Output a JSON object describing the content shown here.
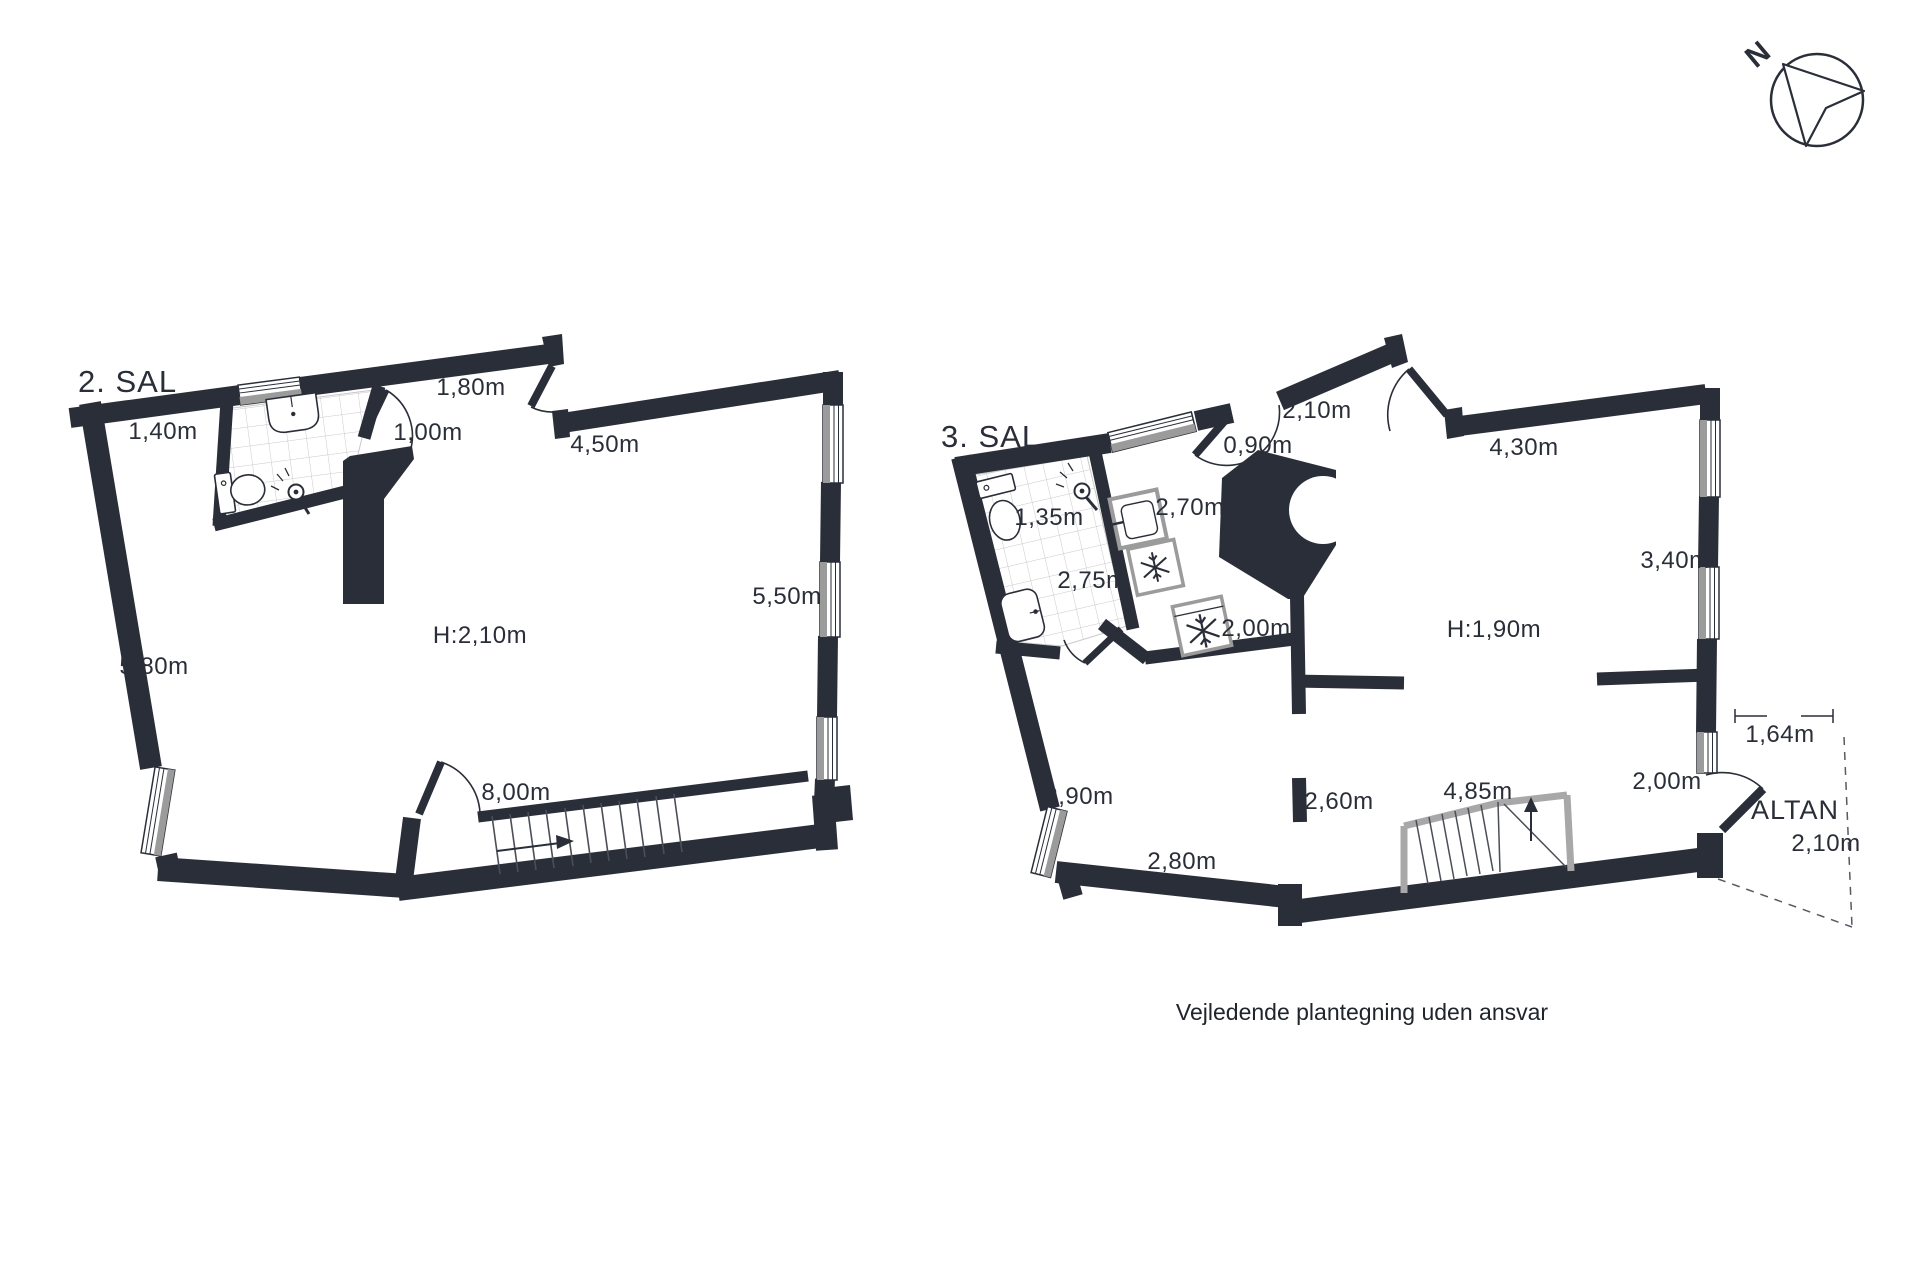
{
  "meta": {
    "footer": "Vejledende plantegning uden ansvar"
  },
  "compass": {
    "north_label": "N"
  },
  "colors": {
    "wall": "#2a2e38",
    "window_gray": "#9b9b9b",
    "tile_line": "#c9c9c9",
    "stair_gray": "#a8a8a8",
    "tread_line": "#4a4e57"
  },
  "plans": [
    {
      "title": "2. SAL",
      "labels": [
        {
          "text": "1,40m"
        },
        {
          "text": "1,80m"
        },
        {
          "text": "1,00m"
        },
        {
          "text": "4,50m"
        },
        {
          "text": "5,50m"
        },
        {
          "text": "5,80m"
        },
        {
          "text": "H:2,10m"
        },
        {
          "text": "8,00m"
        }
      ]
    },
    {
      "title": "3. SAL",
      "labels": [
        {
          "text": "2,10m"
        },
        {
          "text": "0,90m"
        },
        {
          "text": "4,30m"
        },
        {
          "text": "1,35m"
        },
        {
          "text": "2,70m"
        },
        {
          "text": "3,40m"
        },
        {
          "text": "2,75m"
        },
        {
          "text": "2,00m"
        },
        {
          "text": "H:1,90m"
        },
        {
          "text": "2,90m"
        },
        {
          "text": "2,60m"
        },
        {
          "text": "4,85m"
        },
        {
          "text": "2,00m"
        },
        {
          "text": "2,80m"
        },
        {
          "text": "1,64m"
        },
        {
          "text": "ALTAN"
        },
        {
          "text": "2,10m"
        }
      ]
    }
  ]
}
